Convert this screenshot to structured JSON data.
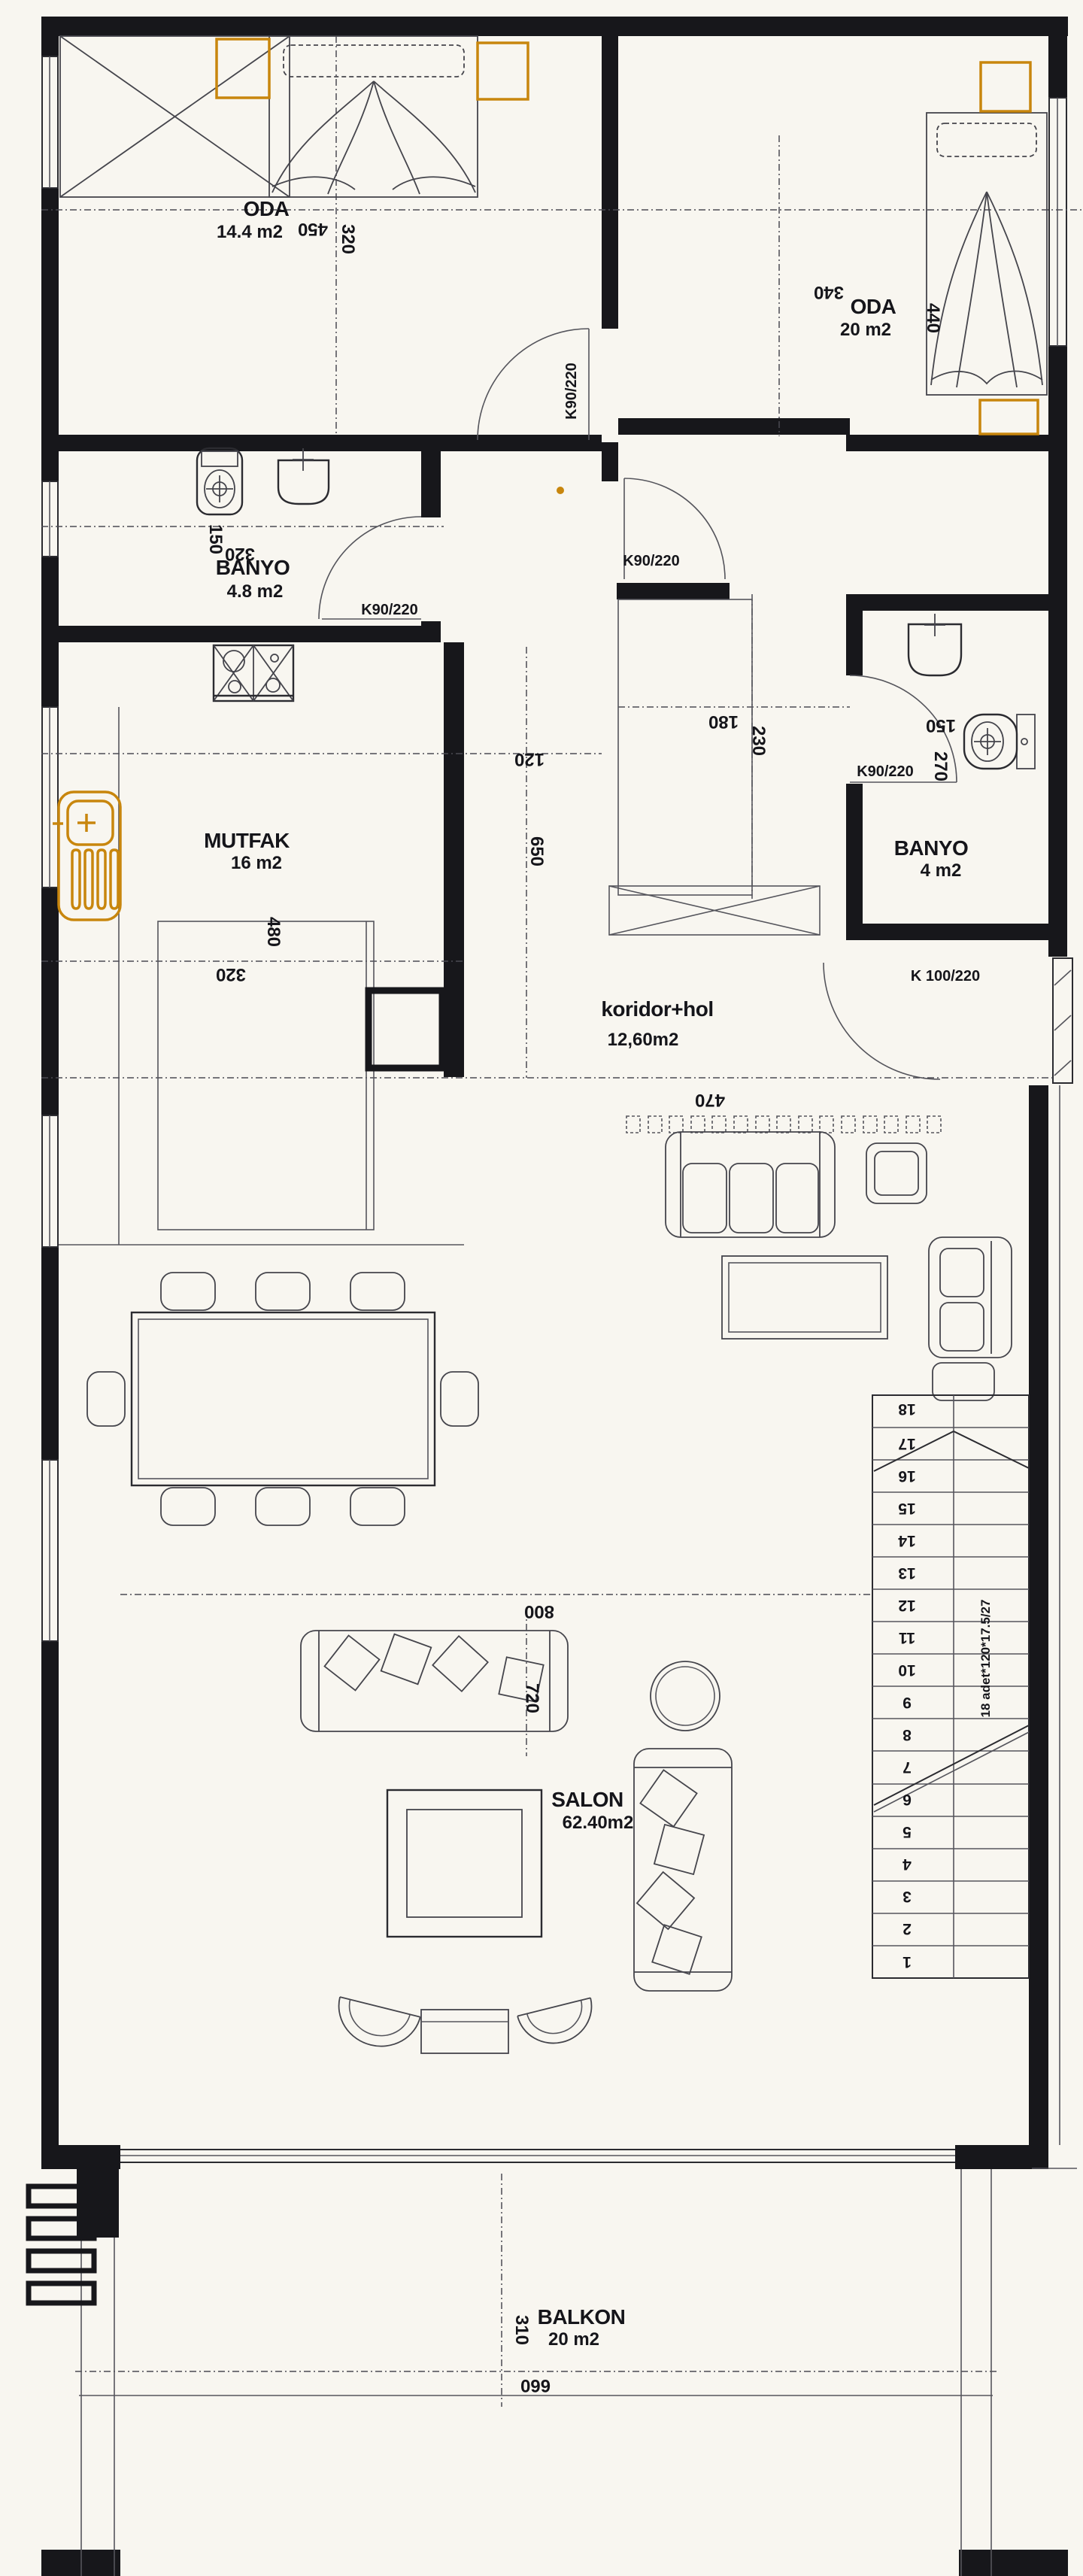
{
  "rooms": {
    "oda1": {
      "name": "ODA",
      "area": "14.4 m2"
    },
    "oda2": {
      "name": "ODA",
      "area": "20 m2"
    },
    "banyo1": {
      "name": "BANYO",
      "area": "4.8 m2"
    },
    "banyo2": {
      "name": "BANYO",
      "area": "4 m2"
    },
    "mutfak": {
      "name": "MUTFAK",
      "area": "16 m2"
    },
    "koridor": {
      "name": "koridor+hol",
      "area": "12,60m2"
    },
    "salon": {
      "name": "SALON",
      "area": "62.40m2"
    },
    "balkon": {
      "name": "BALKON",
      "area": "20 m2"
    }
  },
  "doors": {
    "oda1_door": "K90/220",
    "hall_door": "K90/220",
    "banyo1_door": "K90/220",
    "banyo2_door": "K90/220",
    "entry_door": "K 100/220"
  },
  "dims": {
    "d450": "450",
    "d320_oda1": "320",
    "d340": "340",
    "d440": "440",
    "d150_banyo1": "150",
    "d320_banyo1": "320",
    "d480": "480",
    "d320_mutfak": "320",
    "d120": "120",
    "d650": "650",
    "d180": "180",
    "d230": "230",
    "d150_banyo2": "150",
    "d270": "270",
    "d470": "470",
    "d800": "800",
    "d720": "720",
    "d310": "310",
    "d660": "660"
  },
  "stairs": {
    "numbers": [
      "1",
      "2",
      "3",
      "4",
      "5",
      "6",
      "7",
      "8",
      "9",
      "10",
      "11",
      "12",
      "13",
      "14",
      "15",
      "16",
      "17",
      "18"
    ],
    "note": "18 adet*120*17.5/27"
  },
  "colors": {
    "accent": "#c8860d",
    "ink": "#17171b"
  }
}
